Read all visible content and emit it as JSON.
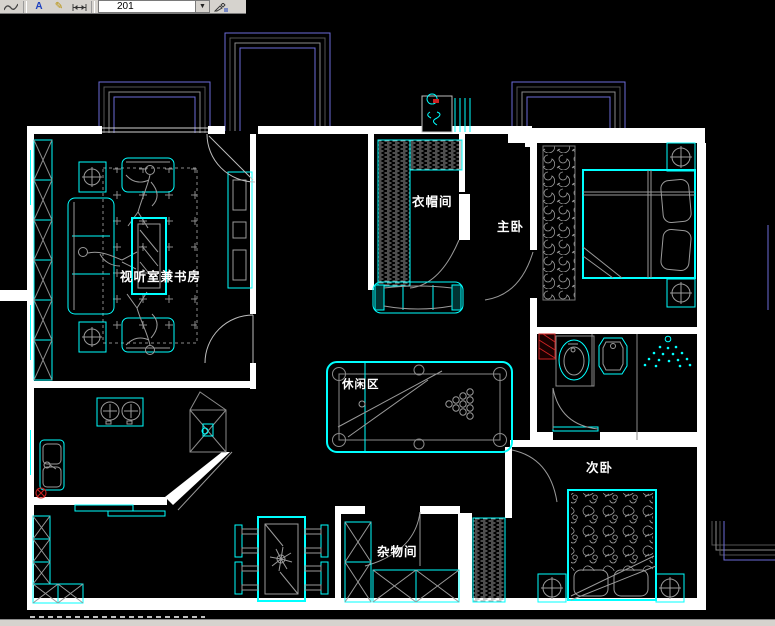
{
  "toolbar": {
    "style_value": "201",
    "icons": [
      "spline-icon",
      "dimension-text-icon",
      "dimension-edit-icon",
      "dimension-linear-icon",
      "dimension-update-icon"
    ],
    "dropdown_arrow": "▼"
  },
  "canvas": {
    "rooms": {
      "study": {
        "label": "视听室兼书房"
      },
      "cloakroom": {
        "label": "衣帽间"
      },
      "master": {
        "label": "主卧"
      },
      "leisure": {
        "label": "休闲区"
      },
      "storage": {
        "label": "杂物间"
      },
      "second": {
        "label": "次卧"
      }
    },
    "colors": {
      "background": "#000000",
      "wall": "#ffffff",
      "furniture_line": "#00ffff",
      "aux_line": "#9a9a9a",
      "balcony_line": "#6b6bd9",
      "accent_red": "#cc2222",
      "toolbar_bg": "#d6d3ce"
    }
  }
}
